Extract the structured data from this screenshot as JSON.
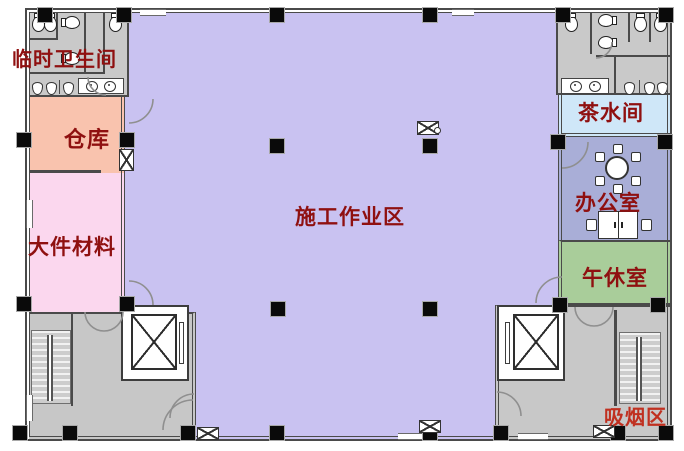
{
  "plan_title": "construction site floor plan",
  "rooms": [
    {
      "key": "temp_toilet",
      "label": "临时卫生间",
      "color": "#c9c9c9"
    },
    {
      "key": "warehouse",
      "label": "仓库",
      "color": "#f9c3ae"
    },
    {
      "key": "materials",
      "label": "大件材料",
      "color": "#fbd7ee"
    },
    {
      "key": "work_area",
      "label": "施工作业区",
      "color": "#c9c2f1"
    },
    {
      "key": "tea_room",
      "label": "茶水间",
      "color": "#cfe7f8"
    },
    {
      "key": "office",
      "label": "办公室",
      "color": "#a9aed7"
    },
    {
      "key": "nap_room",
      "label": "午休室",
      "color": "#a9cd9a"
    },
    {
      "key": "smoking_area",
      "label": "吸烟区",
      "color": "#c8c8c8"
    },
    {
      "key": "tr_toilet",
      "label": "",
      "color": "#c9c9c9"
    },
    {
      "key": "bl_stair_lobby",
      "label": "",
      "color": "#c7c7c7"
    }
  ],
  "colors": {
    "wall": "#4a4a4a",
    "column": "#0a0a0a",
    "label_red": "#8f1010",
    "smoking_red": "#c03020",
    "arc": "#8f8f8f",
    "work_area_fill": "#c9c2f1"
  },
  "icons": {
    "toilet": "toilet-icon",
    "sink": "sink-icon",
    "urinal": "urinal-icon",
    "elevator": "elevator-icon",
    "stairs": "stairs-icon",
    "door_swing": "door-swing-icon",
    "window": "window-icon",
    "column": "structural-column",
    "round_table": "round-table-icon",
    "desk": "desk-icon",
    "chair": "chair-icon"
  }
}
